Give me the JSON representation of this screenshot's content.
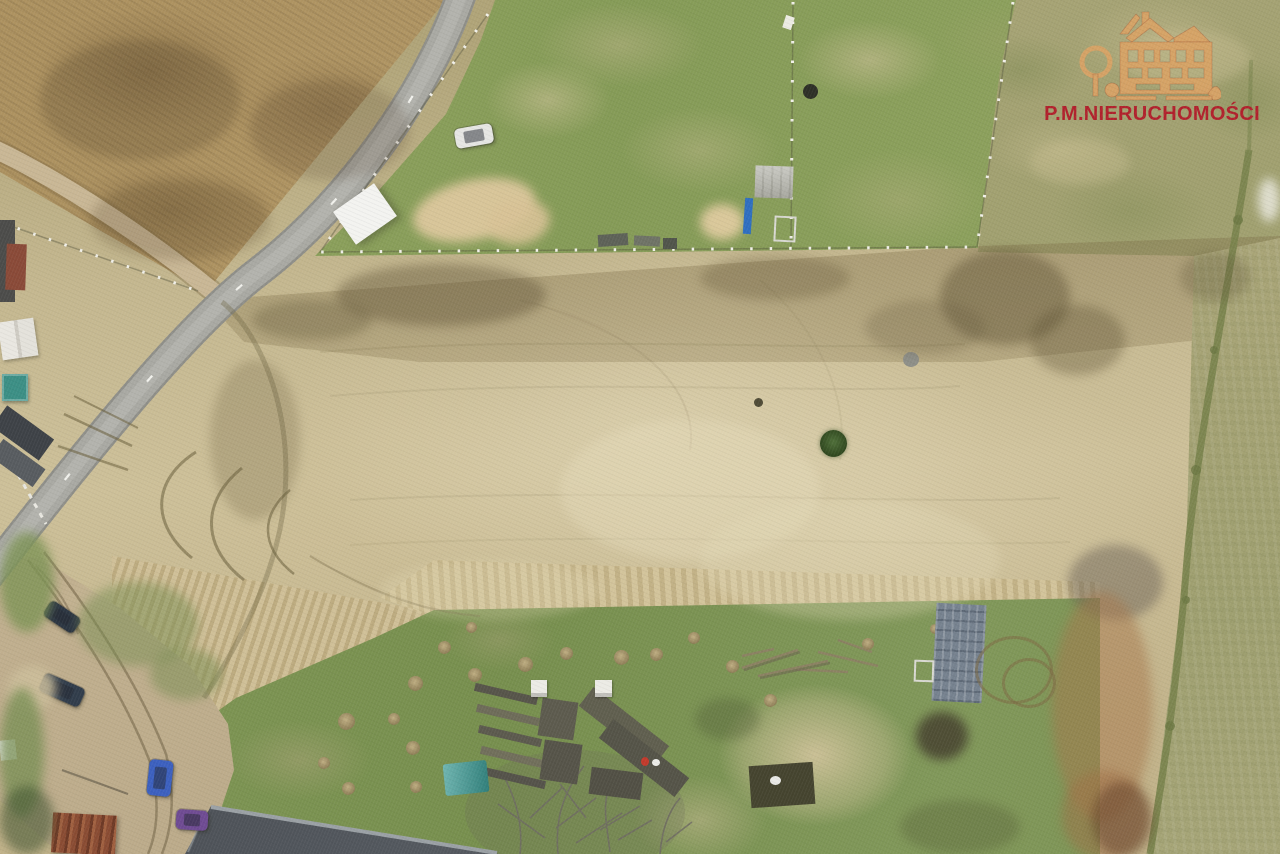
{
  "watermark": {
    "brand_text": "P.M.NIERUCHOMOŚCI",
    "logo": "manor-house-logo",
    "text_color": "#b1212c",
    "logo_color": "#d7a366"
  },
  "scene": {
    "kind": "aerial-drone-photo-of-land-parcels",
    "palette": {
      "meadow": "#c7ba93",
      "meadow_dark_band": "#a69a6f",
      "brown_field": "#a98f5e",
      "lawn_green": "#8ba05c",
      "garden_green": "#7e9655",
      "pasture": "#a5a173",
      "right_strip": "#aaa578",
      "asphalt_road": "#a9a9a3",
      "dirt_road": "#c9b795",
      "big_roof": "#474b51",
      "rust_patch": "#a8784c"
    },
    "objects": [
      {
        "name": "white-car",
        "type": "car",
        "x": 455,
        "y": 126,
        "w": 38,
        "h": 20,
        "rot": -10,
        "color": "#e6e6e3"
      },
      {
        "name": "white-canopy",
        "type": "canopy",
        "x": 340,
        "y": 194,
        "w": 50,
        "h": 40,
        "rot": -35,
        "color": "#f3f3f0"
      },
      {
        "name": "sand-patch-1",
        "type": "smudge",
        "x": 412,
        "y": 180,
        "w": 124,
        "h": 60,
        "rot": -12,
        "color": "rgba(220,199,156,0.95)"
      },
      {
        "name": "sand-patch-2",
        "type": "smudge",
        "x": 488,
        "y": 200,
        "w": 62,
        "h": 44,
        "rot": -10,
        "color": "rgba(216,194,150,0.9)"
      },
      {
        "name": "sand-circle",
        "type": "smudge",
        "x": 700,
        "y": 204,
        "w": 44,
        "h": 36,
        "color": "rgba(222,202,158,0.95)"
      },
      {
        "name": "concrete-pad",
        "type": "pad",
        "x": 755,
        "y": 166,
        "w": 38,
        "h": 32,
        "rot": 2
      },
      {
        "name": "blue-ladder",
        "type": "rect",
        "x": 744,
        "y": 198,
        "w": 8,
        "h": 36,
        "rot": 4,
        "color": "#2f6fc0"
      },
      {
        "name": "gray-frame",
        "type": "frame",
        "x": 774,
        "y": 216,
        "w": 18,
        "h": 22,
        "rot": 3
      },
      {
        "name": "well",
        "type": "blob",
        "x": 803,
        "y": 84,
        "w": 15,
        "h": 15,
        "color": "#2e3027"
      },
      {
        "name": "white-marker",
        "type": "rect",
        "x": 784,
        "y": 16,
        "w": 9,
        "h": 13,
        "rot": 18,
        "color": "#ecebe3"
      },
      {
        "name": "debris-1",
        "type": "rect",
        "x": 598,
        "y": 234,
        "w": 30,
        "h": 12,
        "rot": -4,
        "color": "#5e6258"
      },
      {
        "name": "debris-2",
        "type": "rect",
        "x": 634,
        "y": 236,
        "w": 26,
        "h": 10,
        "rot": 3,
        "color": "#6f7366"
      },
      {
        "name": "debris-3",
        "type": "rect",
        "x": 663,
        "y": 238,
        "w": 14,
        "h": 11,
        "color": "#51554b"
      },
      {
        "name": "teal-shed",
        "type": "shed",
        "x": 2,
        "y": 374,
        "w": 26,
        "h": 27,
        "color": "#3c8f85"
      },
      {
        "name": "white-roof-house",
        "type": "house-white",
        "x": 0,
        "y": 320,
        "w": 36,
        "h": 38,
        "rot": -8
      },
      {
        "name": "dark-roof-house",
        "type": "rect",
        "x": 0,
        "y": 220,
        "w": 15,
        "h": 82,
        "color": "#4c4c4a"
      },
      {
        "name": "red-roof-building",
        "type": "rect",
        "x": 6,
        "y": 244,
        "w": 20,
        "h": 46,
        "rot": 2,
        "color": "#8a4a38"
      },
      {
        "name": "dark-long-roof",
        "type": "rect",
        "x": -6,
        "y": 420,
        "w": 58,
        "h": 26,
        "rot": 36,
        "color": "#3e4247"
      },
      {
        "name": "dark-long-roof-2",
        "type": "rect",
        "x": -8,
        "y": 452,
        "w": 52,
        "h": 22,
        "rot": 36,
        "color": "#585c60"
      },
      {
        "name": "white-shed-small",
        "type": "rect",
        "x": 0,
        "y": 740,
        "w": 16,
        "h": 20,
        "rot": -6,
        "color": "#e9e9e6"
      },
      {
        "name": "rusty-shed",
        "type": "striped-rust",
        "x": 52,
        "y": 814,
        "w": 64,
        "h": 40,
        "rot": 3
      },
      {
        "name": "van-dark-1",
        "type": "car",
        "x": 44,
        "y": 608,
        "w": 36,
        "h": 18,
        "rot": 34,
        "color": "#2c3642"
      },
      {
        "name": "van-dark-2",
        "type": "car",
        "x": 40,
        "y": 680,
        "w": 44,
        "h": 20,
        "rot": 24,
        "color": "#313d4b"
      },
      {
        "name": "blue-car",
        "type": "car",
        "x": 148,
        "y": 760,
        "w": 24,
        "h": 36,
        "rot": 6,
        "color": "#3c60bf"
      },
      {
        "name": "purple-car",
        "type": "car",
        "x": 176,
        "y": 810,
        "w": 32,
        "h": 20,
        "rot": 4,
        "color": "#6f4b93"
      },
      {
        "name": "pale-spot-drive",
        "type": "smudge",
        "x": 8,
        "y": 666,
        "w": 48,
        "h": 44,
        "color": "rgba(205,190,155,0.85)"
      },
      {
        "name": "grass-blob-1",
        "type": "smudge",
        "x": 0,
        "y": 532,
        "w": 54,
        "h": 100,
        "color": "rgba(125,148,85,0.8)"
      },
      {
        "name": "grass-blob-2",
        "type": "smudge",
        "x": 78,
        "y": 582,
        "w": 120,
        "h": 84,
        "color": "rgba(120,142,82,0.5)"
      },
      {
        "name": "grass-blob-3",
        "type": "smudge",
        "x": 150,
        "y": 648,
        "w": 72,
        "h": 52,
        "color": "rgba(118,140,80,0.5)"
      },
      {
        "name": "grass-blob-4",
        "type": "smudge",
        "x": 0,
        "y": 688,
        "w": 44,
        "h": 130,
        "color": "rgba(118,142,82,0.75)"
      },
      {
        "name": "tree-blob-sw",
        "type": "smudge",
        "x": 0,
        "y": 786,
        "w": 54,
        "h": 68,
        "color": "rgba(60,80,45,0.55)"
      },
      {
        "name": "bush",
        "type": "bush",
        "x": 820,
        "y": 430,
        "w": 27,
        "h": 27
      },
      {
        "name": "rock",
        "type": "blob",
        "x": 903,
        "y": 352,
        "w": 16,
        "h": 15,
        "color": "#8f9089"
      },
      {
        "name": "dark-dot",
        "type": "blob",
        "x": 754,
        "y": 398,
        "w": 9,
        "h": 9,
        "color": "#4f4b36"
      },
      {
        "name": "smudge-dark-1",
        "type": "smudge",
        "x": 336,
        "y": 264,
        "w": 210,
        "h": 62,
        "color": "rgba(90,78,50,0.4)"
      },
      {
        "name": "smudge-dark-2",
        "type": "smudge",
        "x": 252,
        "y": 300,
        "w": 120,
        "h": 40,
        "color": "rgba(90,78,50,0.3)"
      },
      {
        "name": "smudge-dark-3",
        "type": "smudge",
        "x": 700,
        "y": 256,
        "w": 150,
        "h": 44,
        "color": "rgba(95,82,52,0.3)"
      },
      {
        "name": "smudge-dark-4",
        "type": "smudge",
        "x": 940,
        "y": 250,
        "w": 130,
        "h": 95,
        "color": "rgba(88,76,48,0.42)"
      },
      {
        "name": "smudge-dark-5",
        "type": "smudge",
        "x": 1030,
        "y": 305,
        "w": 95,
        "h": 70,
        "color": "rgba(88,76,48,0.34)"
      },
      {
        "name": "smudge-dark-6",
        "type": "smudge",
        "x": 1180,
        "y": 252,
        "w": 70,
        "h": 50,
        "color": "rgba(95,85,55,0.3)"
      },
      {
        "name": "smudge-dark-7",
        "type": "smudge",
        "x": 865,
        "y": 300,
        "w": 120,
        "h": 55,
        "color": "rgba(100,88,58,0.25)"
      },
      {
        "name": "smudge-dark-8",
        "type": "smudge",
        "x": 210,
        "y": 360,
        "w": 90,
        "h": 160,
        "color": "rgba(105,92,60,0.25)"
      },
      {
        "name": "gray-smudge",
        "type": "smudge",
        "x": 1068,
        "y": 545,
        "w": 95,
        "h": 75,
        "color": "rgba(100,92,82,0.45)"
      },
      {
        "name": "rust-patch",
        "type": "smudge",
        "x": 1052,
        "y": 592,
        "w": 100,
        "h": 230,
        "color": "rgba(168,120,76,0.5)"
      },
      {
        "name": "rust-patch-2",
        "type": "smudge",
        "x": 1062,
        "y": 770,
        "w": 85,
        "h": 90,
        "color": "rgba(160,112,70,0.5)"
      },
      {
        "name": "dark-brown-corner",
        "type": "smudge",
        "x": 1092,
        "y": 782,
        "w": 60,
        "h": 75,
        "color": "rgba(95,62,40,0.5)"
      },
      {
        "name": "field-dark-1",
        "type": "smudge",
        "x": 40,
        "y": 40,
        "w": 200,
        "h": 120,
        "color": "rgba(80,62,38,0.25)"
      },
      {
        "name": "field-dark-2",
        "type": "smudge",
        "x": 250,
        "y": 80,
        "w": 160,
        "h": 100,
        "color": "rgba(80,62,38,0.2)"
      },
      {
        "name": "field-dark-3",
        "type": "smudge",
        "x": 90,
        "y": 180,
        "w": 180,
        "h": 80,
        "color": "rgba(80,62,38,0.22)"
      },
      {
        "name": "meadow-pale-1",
        "type": "smudge",
        "x": 560,
        "y": 420,
        "w": 260,
        "h": 140,
        "color": "rgba(232,222,188,0.38)"
      },
      {
        "name": "meadow-pale-2",
        "type": "smudge",
        "x": 700,
        "y": 500,
        "w": 300,
        "h": 120,
        "color": "rgba(228,218,184,0.32)"
      },
      {
        "name": "meadow-pale-3",
        "type": "smudge",
        "x": 380,
        "y": 560,
        "w": 220,
        "h": 60,
        "color": "rgba(225,214,180,0.3)"
      },
      {
        "name": "white-patch",
        "type": "smudge",
        "x": 1258,
        "y": 178,
        "w": 22,
        "h": 44,
        "color": "rgba(238,236,228,0.8)"
      },
      {
        "name": "pasture-tan-1",
        "type": "smudge",
        "x": 1120,
        "y": 30,
        "w": 130,
        "h": 55,
        "color": "rgba(198,188,144,0.45)"
      },
      {
        "name": "pasture-tan-2",
        "type": "smudge",
        "x": 1030,
        "y": 140,
        "w": 100,
        "h": 45,
        "color": "rgba(200,190,146,0.4)"
      },
      {
        "name": "mound-1",
        "type": "mound",
        "x": 408,
        "y": 676,
        "w": 15,
        "h": 15
      },
      {
        "name": "mound-2",
        "type": "mound",
        "x": 438,
        "y": 641,
        "w": 13,
        "h": 13
      },
      {
        "name": "mound-3",
        "type": "mound",
        "x": 468,
        "y": 668,
        "w": 14,
        "h": 14
      },
      {
        "name": "mound-4",
        "type": "mound",
        "x": 388,
        "y": 713,
        "w": 12,
        "h": 12
      },
      {
        "name": "mound-5",
        "type": "mound",
        "x": 406,
        "y": 741,
        "w": 14,
        "h": 14
      },
      {
        "name": "mound-6",
        "type": "mound",
        "x": 338,
        "y": 713,
        "w": 17,
        "h": 17
      },
      {
        "name": "mound-7",
        "type": "mound",
        "x": 318,
        "y": 757,
        "w": 12,
        "h": 12
      },
      {
        "name": "mound-8",
        "type": "mound",
        "x": 410,
        "y": 781,
        "w": 12,
        "h": 12
      },
      {
        "name": "mound-9",
        "type": "mound",
        "x": 342,
        "y": 782,
        "w": 13,
        "h": 13
      },
      {
        "name": "mound-10",
        "type": "mound",
        "x": 518,
        "y": 657,
        "w": 15,
        "h": 15
      },
      {
        "name": "mound-11",
        "type": "mound",
        "x": 560,
        "y": 647,
        "w": 13,
        "h": 13
      },
      {
        "name": "mound-12",
        "type": "mound",
        "x": 614,
        "y": 650,
        "w": 15,
        "h": 15
      },
      {
        "name": "mound-13",
        "type": "mound",
        "x": 650,
        "y": 648,
        "w": 13,
        "h": 13
      },
      {
        "name": "mound-14",
        "type": "mound",
        "x": 688,
        "y": 632,
        "w": 12,
        "h": 12
      },
      {
        "name": "mound-15",
        "type": "mound",
        "x": 726,
        "y": 660,
        "w": 13,
        "h": 13
      },
      {
        "name": "mound-16",
        "type": "mound",
        "x": 764,
        "y": 694,
        "w": 13,
        "h": 13
      },
      {
        "name": "mound-17",
        "type": "mound",
        "x": 862,
        "y": 638,
        "w": 12,
        "h": 12
      },
      {
        "name": "mound-18",
        "type": "mound",
        "x": 930,
        "y": 624,
        "w": 10,
        "h": 10
      },
      {
        "name": "mound-19",
        "type": "mound",
        "x": 466,
        "y": 622,
        "w": 11,
        "h": 11
      },
      {
        "name": "bed-strip-1",
        "type": "rect",
        "x": 474,
        "y": 690,
        "w": 64,
        "h": 8,
        "rot": 13,
        "color": "#57554a"
      },
      {
        "name": "bed-strip-2",
        "type": "rect",
        "x": 476,
        "y": 711,
        "w": 64,
        "h": 8,
        "rot": 13,
        "color": "#6e6c59"
      },
      {
        "name": "bed-strip-3",
        "type": "rect",
        "x": 478,
        "y": 732,
        "w": 64,
        "h": 8,
        "rot": 13,
        "color": "#5c5a4e"
      },
      {
        "name": "bed-strip-4",
        "type": "rect",
        "x": 480,
        "y": 753,
        "w": 64,
        "h": 8,
        "rot": 13,
        "color": "#716f5b"
      },
      {
        "name": "bed-strip-5",
        "type": "rect",
        "x": 482,
        "y": 774,
        "w": 64,
        "h": 8,
        "rot": 13,
        "color": "#55534a"
      },
      {
        "name": "dark-bed-a",
        "type": "rect",
        "x": 540,
        "y": 700,
        "w": 36,
        "h": 38,
        "rot": 8,
        "color": "#5d5b4e"
      },
      {
        "name": "dark-bed-b",
        "type": "rect",
        "x": 542,
        "y": 742,
        "w": 38,
        "h": 40,
        "rot": 8,
        "color": "#565449"
      },
      {
        "name": "long-bed-a",
        "type": "rect",
        "x": 576,
        "y": 714,
        "w": 96,
        "h": 24,
        "rot": 38,
        "color": "#605f4f"
      },
      {
        "name": "long-bed-b",
        "type": "rect",
        "x": 596,
        "y": 746,
        "w": 96,
        "h": 24,
        "rot": 38,
        "color": "#555448"
      },
      {
        "name": "bed-c",
        "type": "rect",
        "x": 590,
        "y": 770,
        "w": 52,
        "h": 27,
        "rot": 7,
        "color": "#525045"
      },
      {
        "name": "teal-tarp",
        "type": "tarp",
        "x": 444,
        "y": 762,
        "w": 44,
        "h": 32,
        "rot": -6,
        "color": "#3a9a94"
      },
      {
        "name": "beehive-1",
        "type": "beehive",
        "x": 531,
        "y": 680,
        "w": 16,
        "h": 17,
        "color": "#ecebe5"
      },
      {
        "name": "beehive-2",
        "type": "beehive",
        "x": 595,
        "y": 680,
        "w": 17,
        "h": 17,
        "color": "#ecebe5"
      },
      {
        "name": "person-red",
        "type": "blob",
        "x": 641,
        "y": 757,
        "w": 8,
        "h": 9,
        "color": "#c23a2c"
      },
      {
        "name": "white-sack",
        "type": "blob",
        "x": 652,
        "y": 759,
        "w": 8,
        "h": 7,
        "color": "#ecece8"
      },
      {
        "name": "pallet-grid",
        "type": "grid-pallet",
        "x": 934,
        "y": 604,
        "w": 50,
        "h": 98,
        "rot": 3
      },
      {
        "name": "compost-pile",
        "type": "smudge",
        "x": 916,
        "y": 712,
        "w": 52,
        "h": 48,
        "color": "rgba(66,60,44,0.8)"
      },
      {
        "name": "white-frame",
        "type": "frame",
        "x": 914,
        "y": 660,
        "w": 16,
        "h": 18,
        "rot": 2
      },
      {
        "name": "track-ring-1",
        "type": "ring",
        "x": 975,
        "y": 636,
        "w": 72,
        "h": 62
      },
      {
        "name": "track-ring-2",
        "type": "ring",
        "x": 1002,
        "y": 658,
        "w": 48,
        "h": 44
      },
      {
        "name": "dark-plot",
        "type": "rect",
        "x": 750,
        "y": 764,
        "w": 64,
        "h": 42,
        "rot": -4,
        "color": "#45442f"
      },
      {
        "name": "white-bag",
        "type": "blob",
        "x": 770,
        "y": 776,
        "w": 11,
        "h": 9,
        "color": "#e9e9e6"
      },
      {
        "name": "garden-dark-1",
        "type": "smudge",
        "x": 695,
        "y": 698,
        "w": 65,
        "h": 42,
        "color": "rgba(70,78,45,0.3)"
      },
      {
        "name": "garden-dark-2",
        "type": "smudge",
        "x": 900,
        "y": 800,
        "w": 120,
        "h": 54,
        "color": "rgba(75,84,48,0.3)"
      }
    ]
  }
}
